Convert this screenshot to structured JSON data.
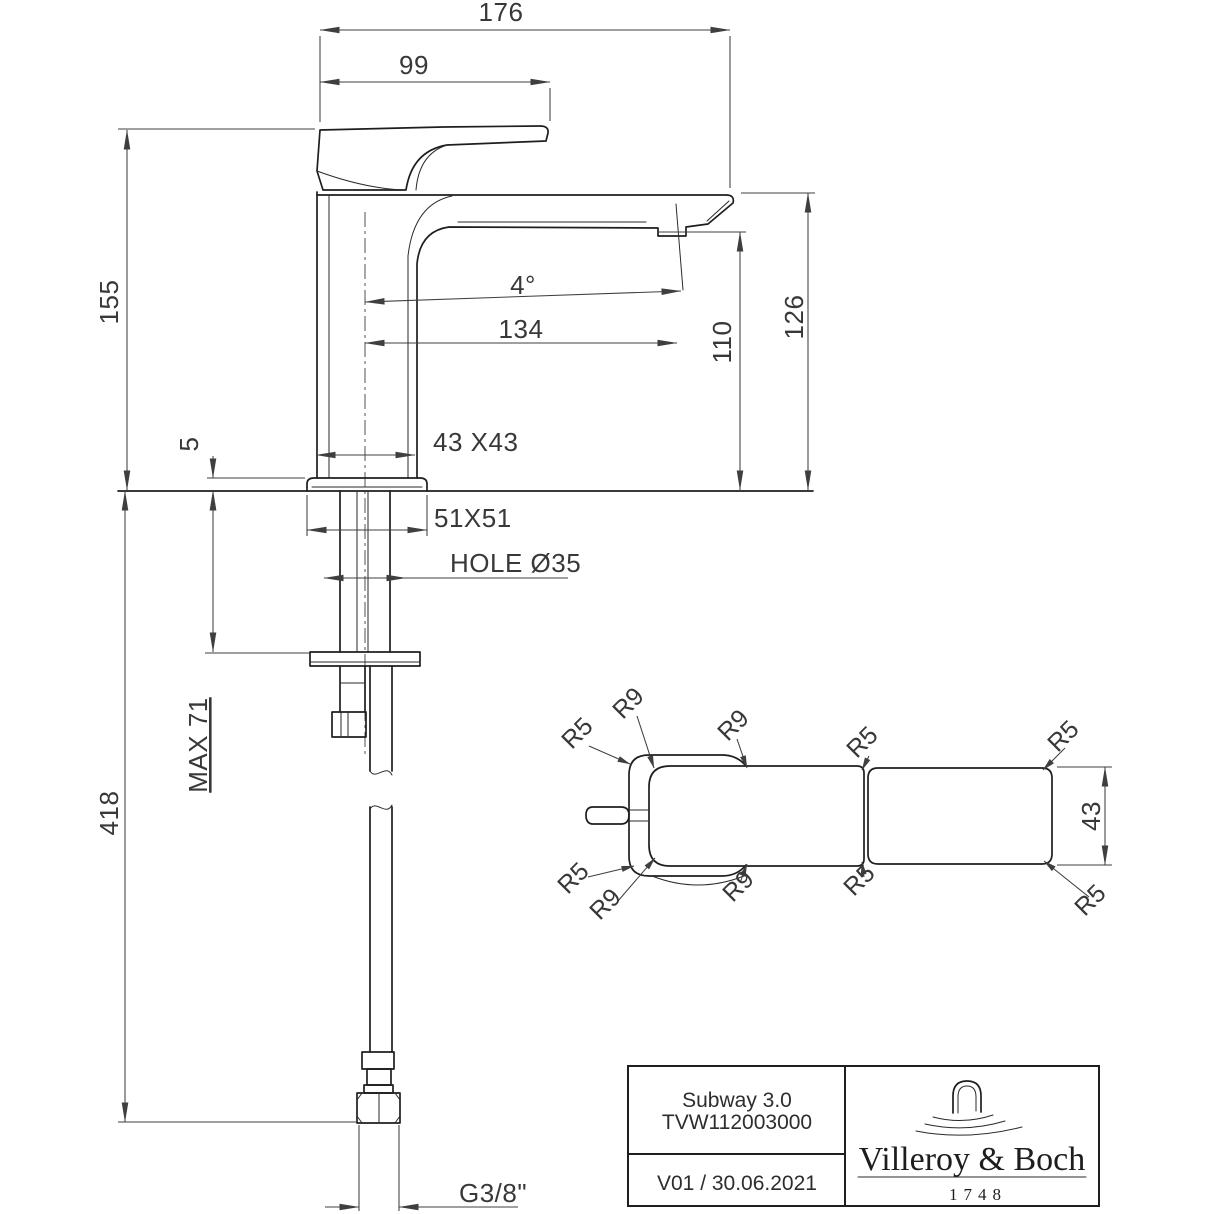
{
  "colors": {
    "background": "#ffffff",
    "object_line": "#1e1e1e",
    "dimension_line": "#3f3f3f"
  },
  "front_view": {
    "dimensions": {
      "overall_projection": "176",
      "handle_projection": "99",
      "height_to_top": "155",
      "escutcheon_height": "5",
      "body_cross_section": "43 X43",
      "escutcheon_cross_section": "51X51",
      "mounting_hole": "HOLE Ø35",
      "max_deck_thickness": "MAX 71",
      "hose_length": "418",
      "spray_angle": "4°",
      "spout_reach": "134",
      "outlet_height": "110",
      "spout_top_height": "126",
      "supply_connection": "G3/8\""
    }
  },
  "top_view": {
    "dimensions": {
      "body_width": "43"
    },
    "radius_labels": [
      "R5",
      "R9",
      "R9",
      "R5",
      "R5",
      "R5",
      "R9",
      "R9",
      "R5",
      "R5"
    ]
  },
  "title_block": {
    "product_name": "Subway 3.0",
    "article_number": "TVW112003000",
    "version_date": "V01 / 30.06.2021",
    "brand": "Villeroy & Boch",
    "brand_year": "1748"
  }
}
